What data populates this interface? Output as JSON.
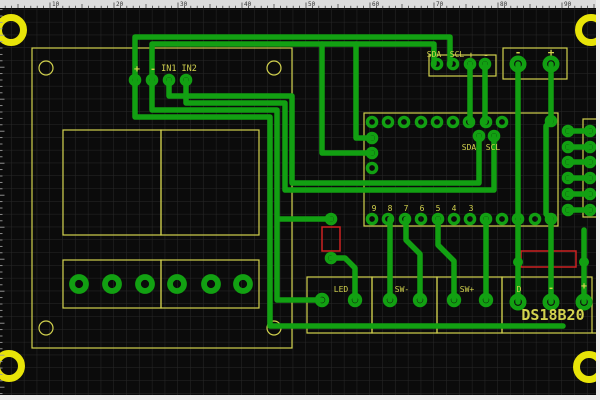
{
  "app": {
    "canvas_title": "PCB layout canvas"
  },
  "colors": {
    "background": "#0b0b0b",
    "grid": "#282828",
    "copper": "#12a012",
    "silkscreen": "#d2d24e",
    "mount_ring": "#e8e408",
    "highlight": "#cc2222",
    "ruler_bg": "#dcdcdc",
    "ruler_tick": "#444444",
    "ruler_text": "#333333",
    "left_tick": "#9a9a9a",
    "edge_strip": "#ededed"
  },
  "rulers": {
    "top": {
      "labels": [
        {
          "v": "10",
          "x": 50
        },
        {
          "v": "20",
          "x": 114
        },
        {
          "v": "30",
          "x": 178
        },
        {
          "v": "40",
          "x": 242
        },
        {
          "v": "50",
          "x": 306
        },
        {
          "v": "60",
          "x": 370
        },
        {
          "v": "70",
          "x": 434
        },
        {
          "v": "80",
          "x": 498
        },
        {
          "v": "90",
          "x": 562
        }
      ],
      "unit_px": 6.4,
      "origin_x": -14
    },
    "left": {
      "unit_px": 6.4,
      "origin_y": 3.2
    }
  },
  "silkscreen": {
    "labels": [
      {
        "t": "+",
        "x": 137,
        "y": 72,
        "s": 10,
        "b": 1
      },
      {
        "t": "-",
        "x": 153,
        "y": 72,
        "s": 10,
        "b": 1
      },
      {
        "t": "IN1 IN2",
        "x": 179,
        "y": 71,
        "s": 8.5
      },
      {
        "t": "SDA",
        "x": 434,
        "y": 57,
        "s": 8
      },
      {
        "t": "SCL",
        "x": 457,
        "y": 57,
        "s": 8
      },
      {
        "t": "+",
        "x": 471,
        "y": 58,
        "s": 9,
        "b": 1
      },
      {
        "t": "-",
        "x": 486,
        "y": 58,
        "s": 9,
        "b": 1
      },
      {
        "t": "-",
        "x": 518,
        "y": 56,
        "s": 11,
        "b": 1
      },
      {
        "t": "+",
        "x": 551,
        "y": 56,
        "s": 11,
        "b": 1
      },
      {
        "t": "SDA",
        "x": 469,
        "y": 150,
        "s": 8
      },
      {
        "t": "SCL",
        "x": 493,
        "y": 150,
        "s": 8
      },
      {
        "t": "9",
        "x": 374,
        "y": 211,
        "s": 8
      },
      {
        "t": "8",
        "x": 390,
        "y": 211,
        "s": 8
      },
      {
        "t": "7",
        "x": 406,
        "y": 211,
        "s": 8
      },
      {
        "t": "6",
        "x": 422,
        "y": 211,
        "s": 8
      },
      {
        "t": "5",
        "x": 438,
        "y": 211,
        "s": 8
      },
      {
        "t": "4",
        "x": 454,
        "y": 211,
        "s": 8
      },
      {
        "t": "3",
        "x": 471,
        "y": 211,
        "s": 8
      },
      {
        "t": "LED",
        "x": 341,
        "y": 292,
        "s": 8
      },
      {
        "t": "SW-",
        "x": 402,
        "y": 292,
        "s": 8
      },
      {
        "t": "SW+",
        "x": 467,
        "y": 292,
        "s": 8
      },
      {
        "t": "D",
        "x": 519,
        "y": 292,
        "s": 8
      },
      {
        "t": "-",
        "x": 551,
        "y": 291,
        "s": 10,
        "b": 1
      },
      {
        "t": "+",
        "x": 584,
        "y": 289,
        "s": 10,
        "b": 1
      },
      {
        "t": "DS18B20",
        "x": 553,
        "y": 320,
        "s": 15,
        "b": 1
      }
    ],
    "rects": [
      [
        32,
        48,
        260,
        300
      ],
      [
        63,
        130,
        98,
        105
      ],
      [
        161,
        130,
        98,
        105
      ],
      [
        63,
        260,
        98,
        48
      ],
      [
        161,
        260,
        98,
        48
      ],
      [
        429,
        55,
        67,
        21
      ],
      [
        503,
        48,
        64,
        31
      ],
      [
        364,
        113,
        194,
        113
      ],
      [
        583,
        119,
        17,
        98
      ],
      [
        307,
        277,
        65,
        56
      ],
      [
        372,
        277,
        65,
        56
      ],
      [
        437,
        277,
        65,
        56
      ],
      [
        502,
        277,
        90,
        56
      ]
    ],
    "lines": [
      [
        592,
        333,
        600,
        333
      ]
    ],
    "circles": [
      [
        46,
        68
      ],
      [
        274,
        68
      ],
      [
        46,
        328
      ],
      [
        274,
        328
      ]
    ],
    "mount_rings": [
      [
        11,
        30
      ],
      [
        591,
        30
      ],
      [
        9,
        366
      ],
      [
        589,
        367
      ]
    ]
  },
  "copper": {
    "traces": [
      "M135,80 L135,37 L450,37 L450,64",
      "M152,80 L152,44 L434,44 L434,64",
      "M169,80 L169,96 L292,96 L292,183 L479,183 L479,136",
      "M186,80 L186,103 L285,103 L285,190 L494,190 L494,136",
      "M152,80 L152,110 L277,110 L277,300 L322,300",
      "M135,80 L135,117 L270,117 L270,326 L563,326",
      "M322,44 L322,153 L372,153",
      "M356,44 L356,138 L372,138",
      "M470,64 L470,122",
      "M485,64 L485,122",
      "M518,64 L518,302",
      "M551,64 L551,121",
      "M551,121 L546,126 L546,214 L551,219",
      "M551,219 L551,302",
      "M584,302 L584,230",
      "M390,219 L390,300",
      "M406,219 L406,240 L420,254 L420,300",
      "M438,219 L438,245 L454,261 L454,300",
      "M486,219 L486,300",
      "M355,300 L355,268 L345,258 L331,258",
      "M331,219 L278,219",
      "M568,131 L590,131",
      "M568,147 L590,147",
      "M568,162 L590,162",
      "M568,178 L590,178",
      "M568,194 L590,194",
      "M568,210 L590,210"
    ],
    "pads": [
      {
        "type": "small",
        "points": [
          [
            135,
            80
          ],
          [
            152,
            80
          ],
          [
            169,
            80
          ],
          [
            186,
            80
          ],
          [
            437,
            64
          ],
          [
            453,
            64
          ],
          [
            470,
            64
          ],
          [
            485,
            64
          ],
          [
            372,
            122
          ],
          [
            388,
            122
          ],
          [
            404,
            122
          ],
          [
            421,
            122
          ],
          [
            437,
            122
          ],
          [
            453,
            122
          ],
          [
            469,
            122
          ],
          [
            486,
            122
          ],
          [
            502,
            122
          ],
          [
            372,
            138
          ],
          [
            372,
            153
          ],
          [
            372,
            168
          ],
          [
            479,
            136
          ],
          [
            494,
            136
          ],
          [
            372,
            219
          ],
          [
            388,
            219
          ],
          [
            405,
            219
          ],
          [
            421,
            219
          ],
          [
            438,
            219
          ],
          [
            454,
            219
          ],
          [
            470,
            219
          ],
          [
            486,
            219
          ],
          [
            502,
            219
          ],
          [
            518,
            219
          ],
          [
            535,
            219
          ],
          [
            551,
            219
          ],
          [
            568,
            131
          ],
          [
            590,
            131
          ],
          [
            568,
            147
          ],
          [
            590,
            147
          ],
          [
            568,
            162
          ],
          [
            590,
            162
          ],
          [
            568,
            178
          ],
          [
            590,
            178
          ],
          [
            568,
            194
          ],
          [
            590,
            194
          ],
          [
            568,
            210
          ],
          [
            590,
            210
          ],
          [
            551,
            121
          ],
          [
            331,
            219
          ],
          [
            331,
            258
          ]
        ]
      },
      {
        "type": "tiny",
        "points": [
          [
            518,
            262
          ],
          [
            584,
            262
          ]
        ]
      },
      {
        "type": "medium",
        "points": [
          [
            322,
            300
          ],
          [
            355,
            300
          ],
          [
            390,
            300
          ],
          [
            420,
            300
          ],
          [
            454,
            300
          ],
          [
            486,
            300
          ]
        ]
      },
      {
        "type": "large",
        "points": [
          [
            518,
            64
          ],
          [
            551,
            64
          ],
          [
            518,
            302
          ],
          [
            551,
            302
          ],
          [
            584,
            302
          ]
        ]
      },
      {
        "type": "xlarge",
        "points": [
          [
            79,
            284
          ],
          [
            112,
            284
          ],
          [
            145,
            284
          ],
          [
            177,
            284
          ],
          [
            211,
            284
          ],
          [
            243,
            284
          ]
        ]
      }
    ]
  },
  "highlight_boxes": [
    [
      322,
      227,
      18,
      24
    ],
    [
      521,
      251,
      55,
      16
    ]
  ]
}
